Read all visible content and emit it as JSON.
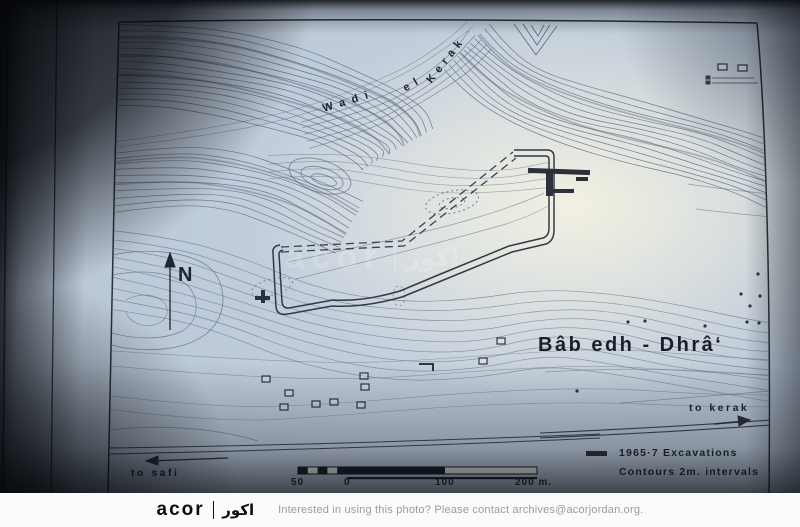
{
  "map": {
    "title": "Bâb edh - Dhrâ‘",
    "wadi_label": {
      "w1": "Wadi",
      "w2": "el",
      "w3": "Kerak"
    },
    "north": "N",
    "to_kerak": "to kerak",
    "to_safi": "to safi",
    "legend": {
      "excavations": "1965·7 Excavations",
      "contours": "Contours 2m. intervals"
    },
    "scale": {
      "left": "50",
      "zero": "0",
      "mid": "100",
      "right": "200 m."
    }
  },
  "watermark": {
    "logo_latin": "acor",
    "logo_arabic": "اكور"
  },
  "footer": {
    "logo_latin": "acor",
    "logo_arabic": "اكور",
    "message": "Interested in using this photo? Please contact archives@acorjordan.org."
  }
}
